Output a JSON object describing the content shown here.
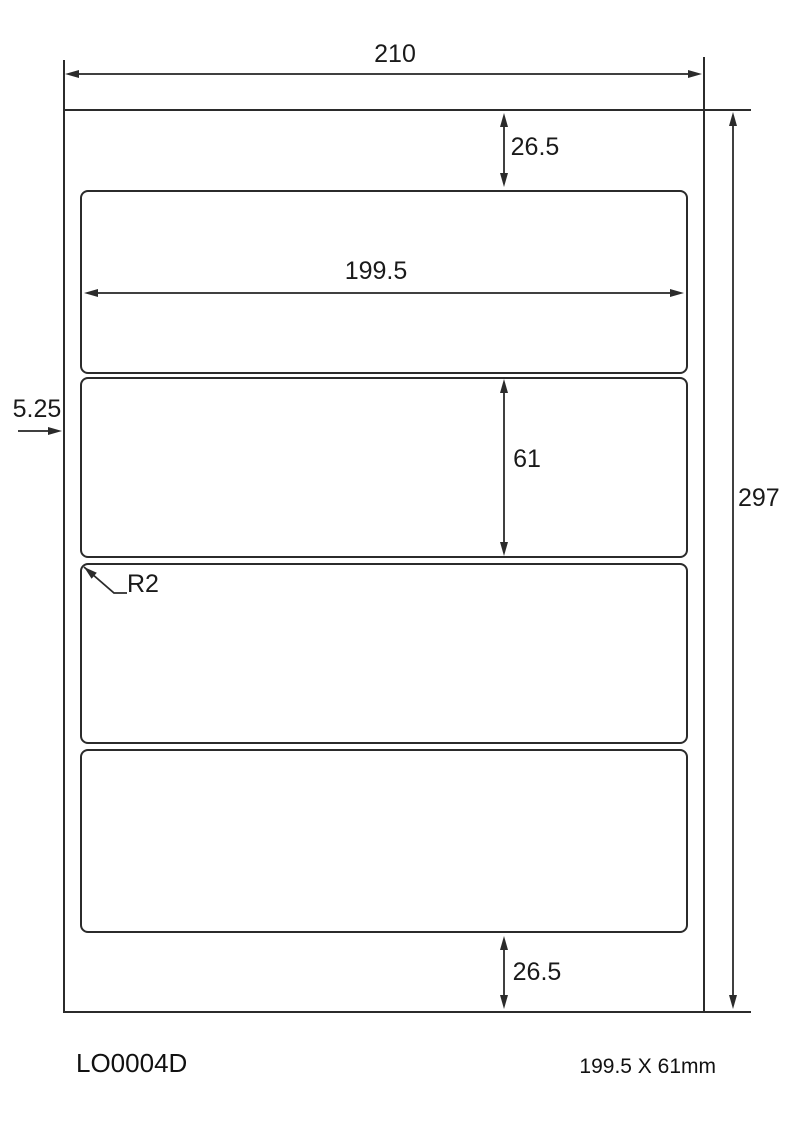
{
  "diagram": {
    "product_code": "LO0004D",
    "label_size_text": "199.5 X 61mm",
    "labels_count": 4,
    "dims": {
      "sheet_width": "210",
      "sheet_height": "297",
      "label_width": "199.5",
      "label_height": "61",
      "margin_top": "26.5",
      "margin_bottom": "26.5",
      "margin_left": "5.25",
      "corner_radius": "R2"
    },
    "colors": {
      "line": "#2b2b2b",
      "text": "#1a1a1a",
      "background": "#ffffff"
    }
  }
}
